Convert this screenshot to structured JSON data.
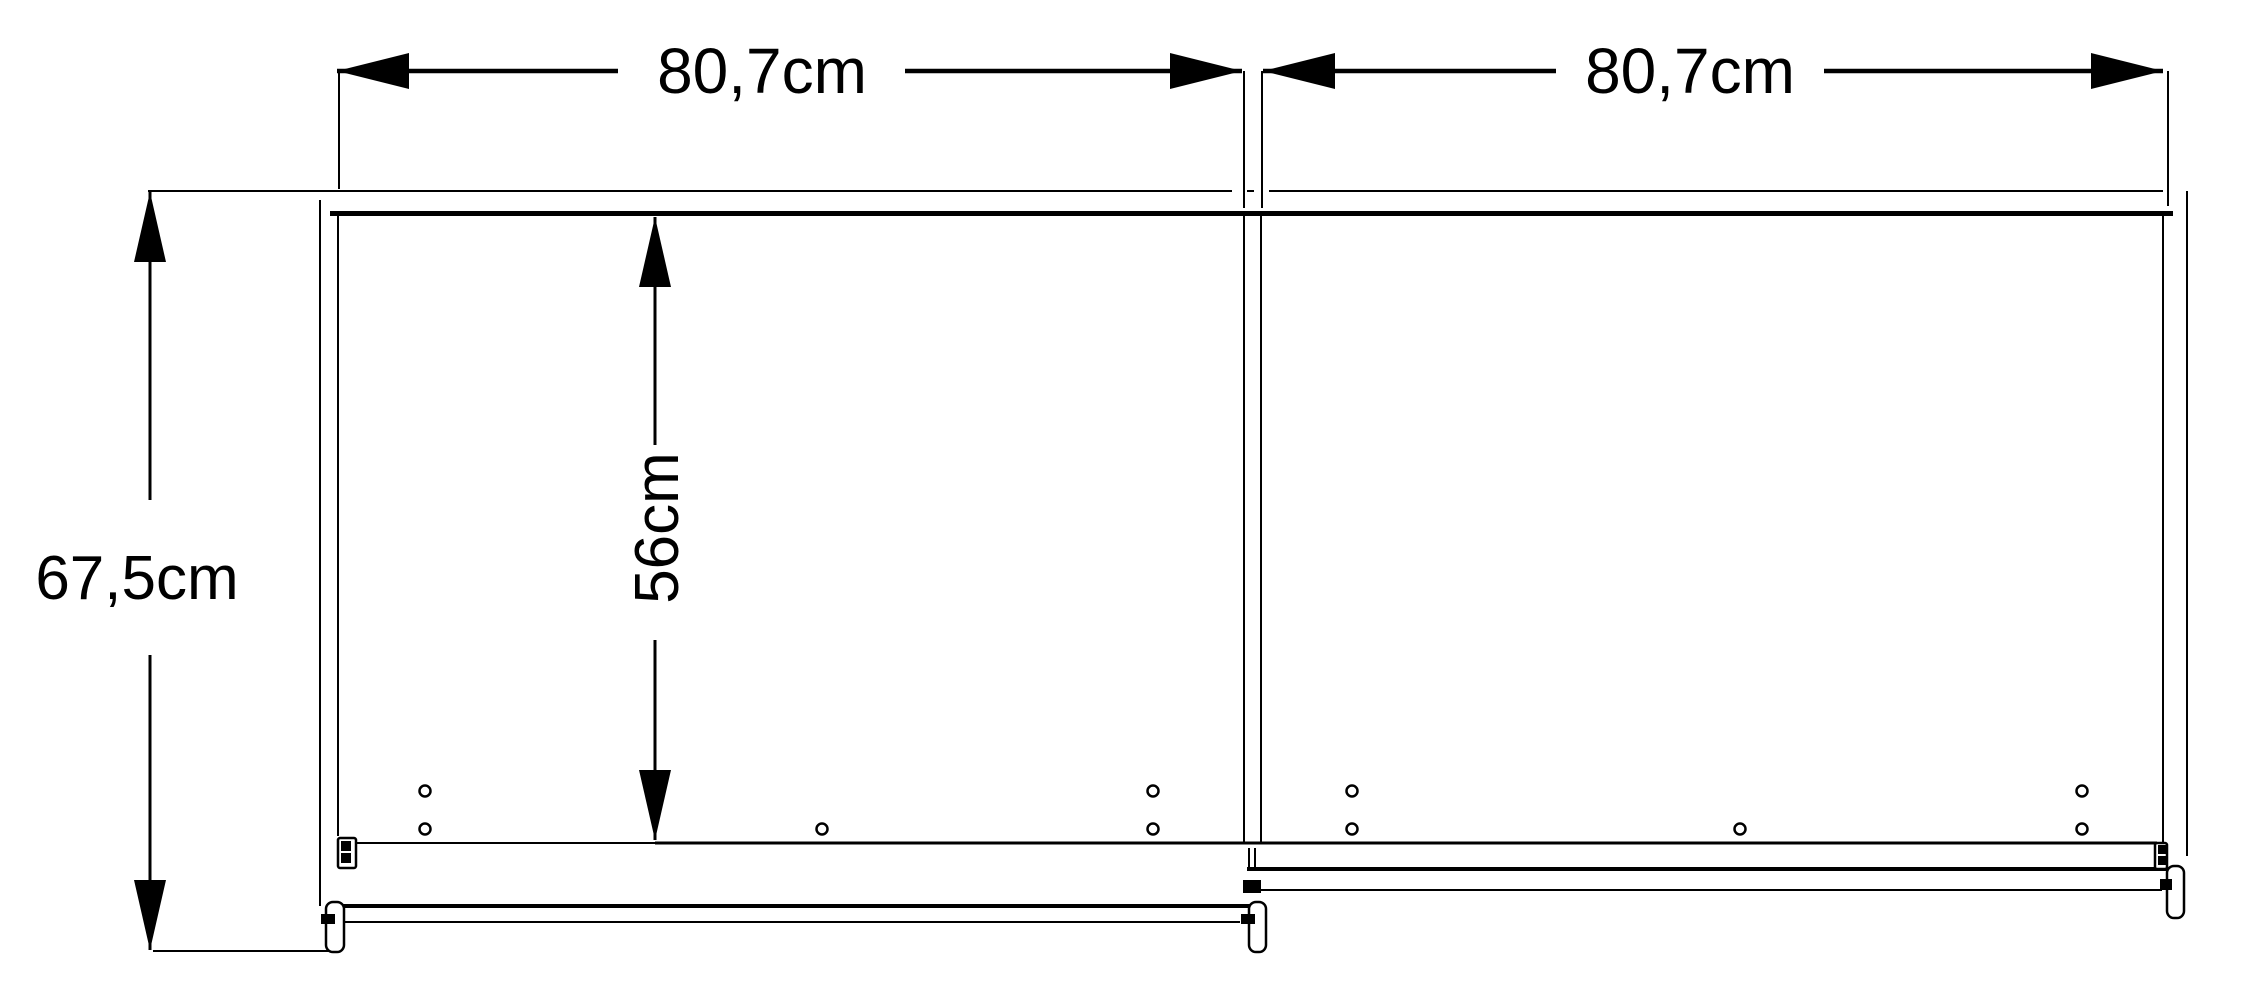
{
  "app": {
    "background": "#ffffff",
    "ink": "#000000"
  },
  "dimensions": [
    {
      "name": "dim-left-door-width",
      "label": "80,7cm",
      "axis": "h",
      "pos": 71,
      "tip1": 337,
      "tip2": 1242,
      "seg1": [
        337,
        618
      ],
      "seg2": [
        905,
        1242
      ],
      "label_x": 762,
      "label_y": 93,
      "font": 64,
      "stroke": 4.5,
      "rotate": false
    },
    {
      "name": "dim-right-door-width",
      "label": "80,7cm",
      "axis": "h",
      "pos": 71,
      "tip1": 1263,
      "tip2": 2163,
      "seg1": [
        1263,
        1556
      ],
      "seg2": [
        1824,
        2163
      ],
      "label_x": 1690,
      "label_y": 93,
      "font": 64,
      "stroke": 4.5,
      "rotate": false
    },
    {
      "name": "dim-total-depth",
      "label": "67,5cm",
      "axis": "v",
      "pos": 150,
      "tip1": 192,
      "tip2": 950,
      "seg1": [
        192,
        500
      ],
      "seg2": [
        655,
        950
      ],
      "label_x": 137,
      "label_y": 599,
      "font": 62,
      "stroke": 3,
      "rotate": false
    },
    {
      "name": "dim-interior-depth",
      "label": "56cm",
      "axis": "v",
      "pos": 655,
      "tip1": 217,
      "tip2": 840,
      "seg1": [
        217,
        445
      ],
      "seg2": [
        640,
        840
      ],
      "label_x": 678,
      "label_y": 528,
      "font": 62,
      "stroke": 3,
      "rotate": true
    }
  ],
  "arrow": {
    "h_len": 72,
    "h_half": 18,
    "v_len": 70,
    "v_half": 16
  },
  "structure": {
    "lines": [
      {
        "name": "back-panel-edge-left",
        "x1": 337,
        "y1": 191,
        "x2": 1232,
        "y2": 191,
        "w": 2
      },
      {
        "name": "back-panel-edge-dash",
        "x1": 1247,
        "y1": 191,
        "x2": 1254,
        "y2": 191,
        "w": 2
      },
      {
        "name": "back-panel-edge-right",
        "x1": 1269,
        "y1": 191,
        "x2": 2163,
        "y2": 191,
        "w": 2
      },
      {
        "name": "top-rail-thick",
        "x1": 330,
        "y1": 213.5,
        "x2": 2173,
        "y2": 213.5,
        "w": 5
      },
      {
        "name": "ext-line-dim1-left",
        "x1": 339,
        "y1": 71,
        "x2": 339,
        "y2": 189,
        "w": 2
      },
      {
        "name": "ext-line-dim1-right",
        "x1": 1244,
        "y1": 71,
        "x2": 1244,
        "y2": 208,
        "w": 2
      },
      {
        "name": "ext-line-dim2-left",
        "x1": 1262,
        "y1": 71,
        "x2": 1262,
        "y2": 208,
        "w": 2
      },
      {
        "name": "ext-line-dim2-right",
        "x1": 2168,
        "y1": 71,
        "x2": 2168,
        "y2": 206,
        "w": 2
      },
      {
        "name": "ext-line-depth-top",
        "x1": 148,
        "y1": 191,
        "x2": 337,
        "y2": 191,
        "w": 2
      },
      {
        "name": "front-bottom-edge",
        "x1": 153,
        "y1": 951,
        "x2": 332,
        "y2": 951,
        "w": 2
      },
      {
        "name": "left-wall-outer",
        "x1": 320,
        "y1": 200,
        "x2": 320,
        "y2": 906,
        "w": 2
      },
      {
        "name": "left-wall-inner",
        "x1": 338,
        "y1": 216,
        "x2": 338,
        "y2": 836,
        "w": 2
      },
      {
        "name": "right-wall-outer",
        "x1": 2187,
        "y1": 191,
        "x2": 2187,
        "y2": 856,
        "w": 2
      },
      {
        "name": "right-wall-inner",
        "x1": 2163,
        "y1": 216,
        "x2": 2163,
        "y2": 843,
        "w": 2
      },
      {
        "name": "center-divider-left-edge",
        "x1": 1244,
        "y1": 216,
        "x2": 1244,
        "y2": 843,
        "w": 2
      },
      {
        "name": "center-divider-right-edge",
        "x1": 1261,
        "y1": 216,
        "x2": 1261,
        "y2": 843,
        "w": 2
      },
      {
        "name": "interior-bottom-left",
        "x1": 337,
        "y1": 843,
        "x2": 655,
        "y2": 843,
        "w": 2
      },
      {
        "name": "interior-bottom-right",
        "x1": 655,
        "y1": 843,
        "x2": 2157,
        "y2": 843,
        "w": 3
      },
      {
        "name": "left-door-rail-top",
        "x1": 330,
        "y1": 906,
        "x2": 1253,
        "y2": 906,
        "w": 4
      },
      {
        "name": "left-door-rail-bottom",
        "x1": 325,
        "y1": 922,
        "x2": 1240,
        "y2": 922,
        "w": 2
      },
      {
        "name": "right-door-rail-top",
        "x1": 1247,
        "y1": 869,
        "x2": 2177,
        "y2": 869,
        "w": 4
      },
      {
        "name": "right-door-rail-bottom",
        "x1": 1247,
        "y1": 890,
        "x2": 2162,
        "y2": 890,
        "w": 2
      },
      {
        "name": "divider-guide-tick-1",
        "x1": 1249,
        "y1": 848,
        "x2": 1249,
        "y2": 868,
        "w": 2
      },
      {
        "name": "divider-guide-tick-2",
        "x1": 1255,
        "y1": 848,
        "x2": 1255,
        "y2": 868,
        "w": 2
      }
    ],
    "outline_rects": [
      {
        "name": "left-wall-fitting-outline",
        "x": 338,
        "y": 838,
        "w": 18,
        "h": 30,
        "r": 2
      },
      {
        "name": "left-door-left-roller",
        "x": 326,
        "y": 902,
        "w": 18,
        "h": 50,
        "r": 7
      },
      {
        "name": "left-door-right-roller",
        "x": 1249,
        "y": 902,
        "w": 17,
        "h": 50,
        "r": 7
      },
      {
        "name": "right-door-right-roller",
        "x": 2167,
        "y": 866,
        "w": 17,
        "h": 52,
        "r": 7
      },
      {
        "name": "right-wall-fitting-outline",
        "x": 2155,
        "y": 843,
        "w": 12,
        "h": 26,
        "r": 2
      }
    ],
    "filled_rects": [
      {
        "name": "left-wall-fitting-block-1",
        "x": 341,
        "y": 841,
        "w": 10,
        "h": 10
      },
      {
        "name": "left-wall-fitting-block-2",
        "x": 341,
        "y": 853,
        "w": 10,
        "h": 10
      },
      {
        "name": "left-roller-mount-block",
        "x": 321,
        "y": 914,
        "w": 14,
        "h": 10
      },
      {
        "name": "divider-roller-mount-block",
        "x": 1241,
        "y": 914,
        "w": 14,
        "h": 10
      },
      {
        "name": "right-door-divider-mount",
        "x": 1243,
        "y": 880,
        "w": 18,
        "h": 13
      },
      {
        "name": "right-wall-fitting-block-1",
        "x": 2158,
        "y": 845,
        "w": 9,
        "h": 9
      },
      {
        "name": "right-wall-fitting-block-2",
        "x": 2158,
        "y": 856,
        "w": 9,
        "h": 9
      },
      {
        "name": "right-roller-mount-block",
        "x": 2160,
        "y": 879,
        "w": 12,
        "h": 11
      }
    ],
    "holes": [
      {
        "name": "drill-hole",
        "x": 425,
        "y": 791
      },
      {
        "name": "drill-hole",
        "x": 425,
        "y": 829
      },
      {
        "name": "drill-hole",
        "x": 822,
        "y": 829
      },
      {
        "name": "drill-hole",
        "x": 1153,
        "y": 791
      },
      {
        "name": "drill-hole",
        "x": 1153,
        "y": 829
      },
      {
        "name": "drill-hole",
        "x": 1352,
        "y": 791
      },
      {
        "name": "drill-hole",
        "x": 1352,
        "y": 829
      },
      {
        "name": "drill-hole",
        "x": 1740,
        "y": 829
      },
      {
        "name": "drill-hole",
        "x": 2082,
        "y": 791
      },
      {
        "name": "drill-hole",
        "x": 2082,
        "y": 829
      }
    ],
    "hole_style": {
      "r": 5.5,
      "stroke": 2.5
    }
  }
}
